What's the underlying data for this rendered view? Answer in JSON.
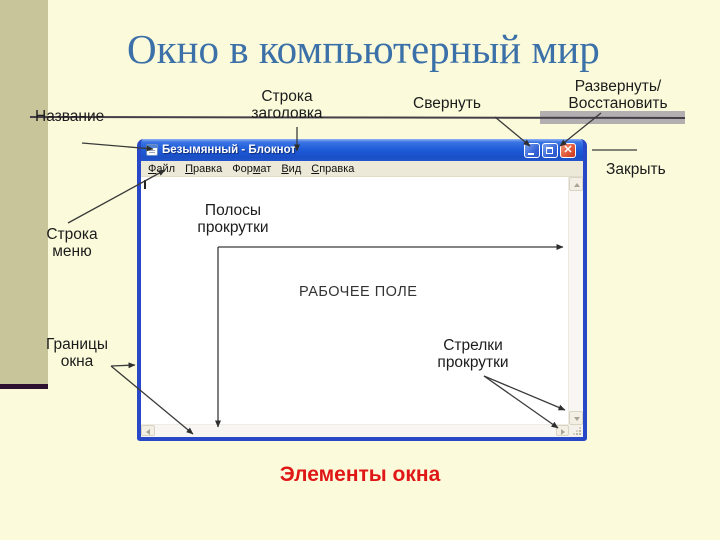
{
  "slide": {
    "title": "Окно в компьютерный мир",
    "caption": "Элементы окна"
  },
  "labels": {
    "nazvanie": "Название",
    "stroka_zagolovka_1": "Строка",
    "stroka_zagolovka_2": "заголовка",
    "svernut": "Свернуть",
    "razvernut_1": "Развернуть/",
    "razvernut_2": "Восстановить",
    "zakryt": "Закрыть",
    "stroka_menyu_1": "Строка",
    "stroka_menyu_2": "меню",
    "polosy_1": "Полосы",
    "polosy_2": "прокрутки",
    "granitsy_1": "Границы",
    "granitsy_2": "окна",
    "strelki_1": "Стрелки",
    "strelki_2": "прокрутки",
    "rabochee_pole": "РАБОЧЕЕ ПОЛЕ"
  },
  "window": {
    "title": "Безымянный - Блокнот",
    "menu": [
      {
        "pre": "",
        "accel": "Ф",
        "post": "айл"
      },
      {
        "pre": "",
        "accel": "П",
        "post": "равка"
      },
      {
        "pre": "Фор",
        "accel": "м",
        "post": "ат"
      },
      {
        "pre": "",
        "accel": "В",
        "post": "ид"
      },
      {
        "pre": "",
        "accel": "С",
        "post": "правка"
      }
    ]
  },
  "colors": {
    "background": "#FBFBDB",
    "stripe-olive": "#C8C59B",
    "accent-blue": "#3B70A8",
    "caption-red": "#E01717",
    "titlebar-blue": "#1E5BD8",
    "close-red": "#E35A3C"
  }
}
